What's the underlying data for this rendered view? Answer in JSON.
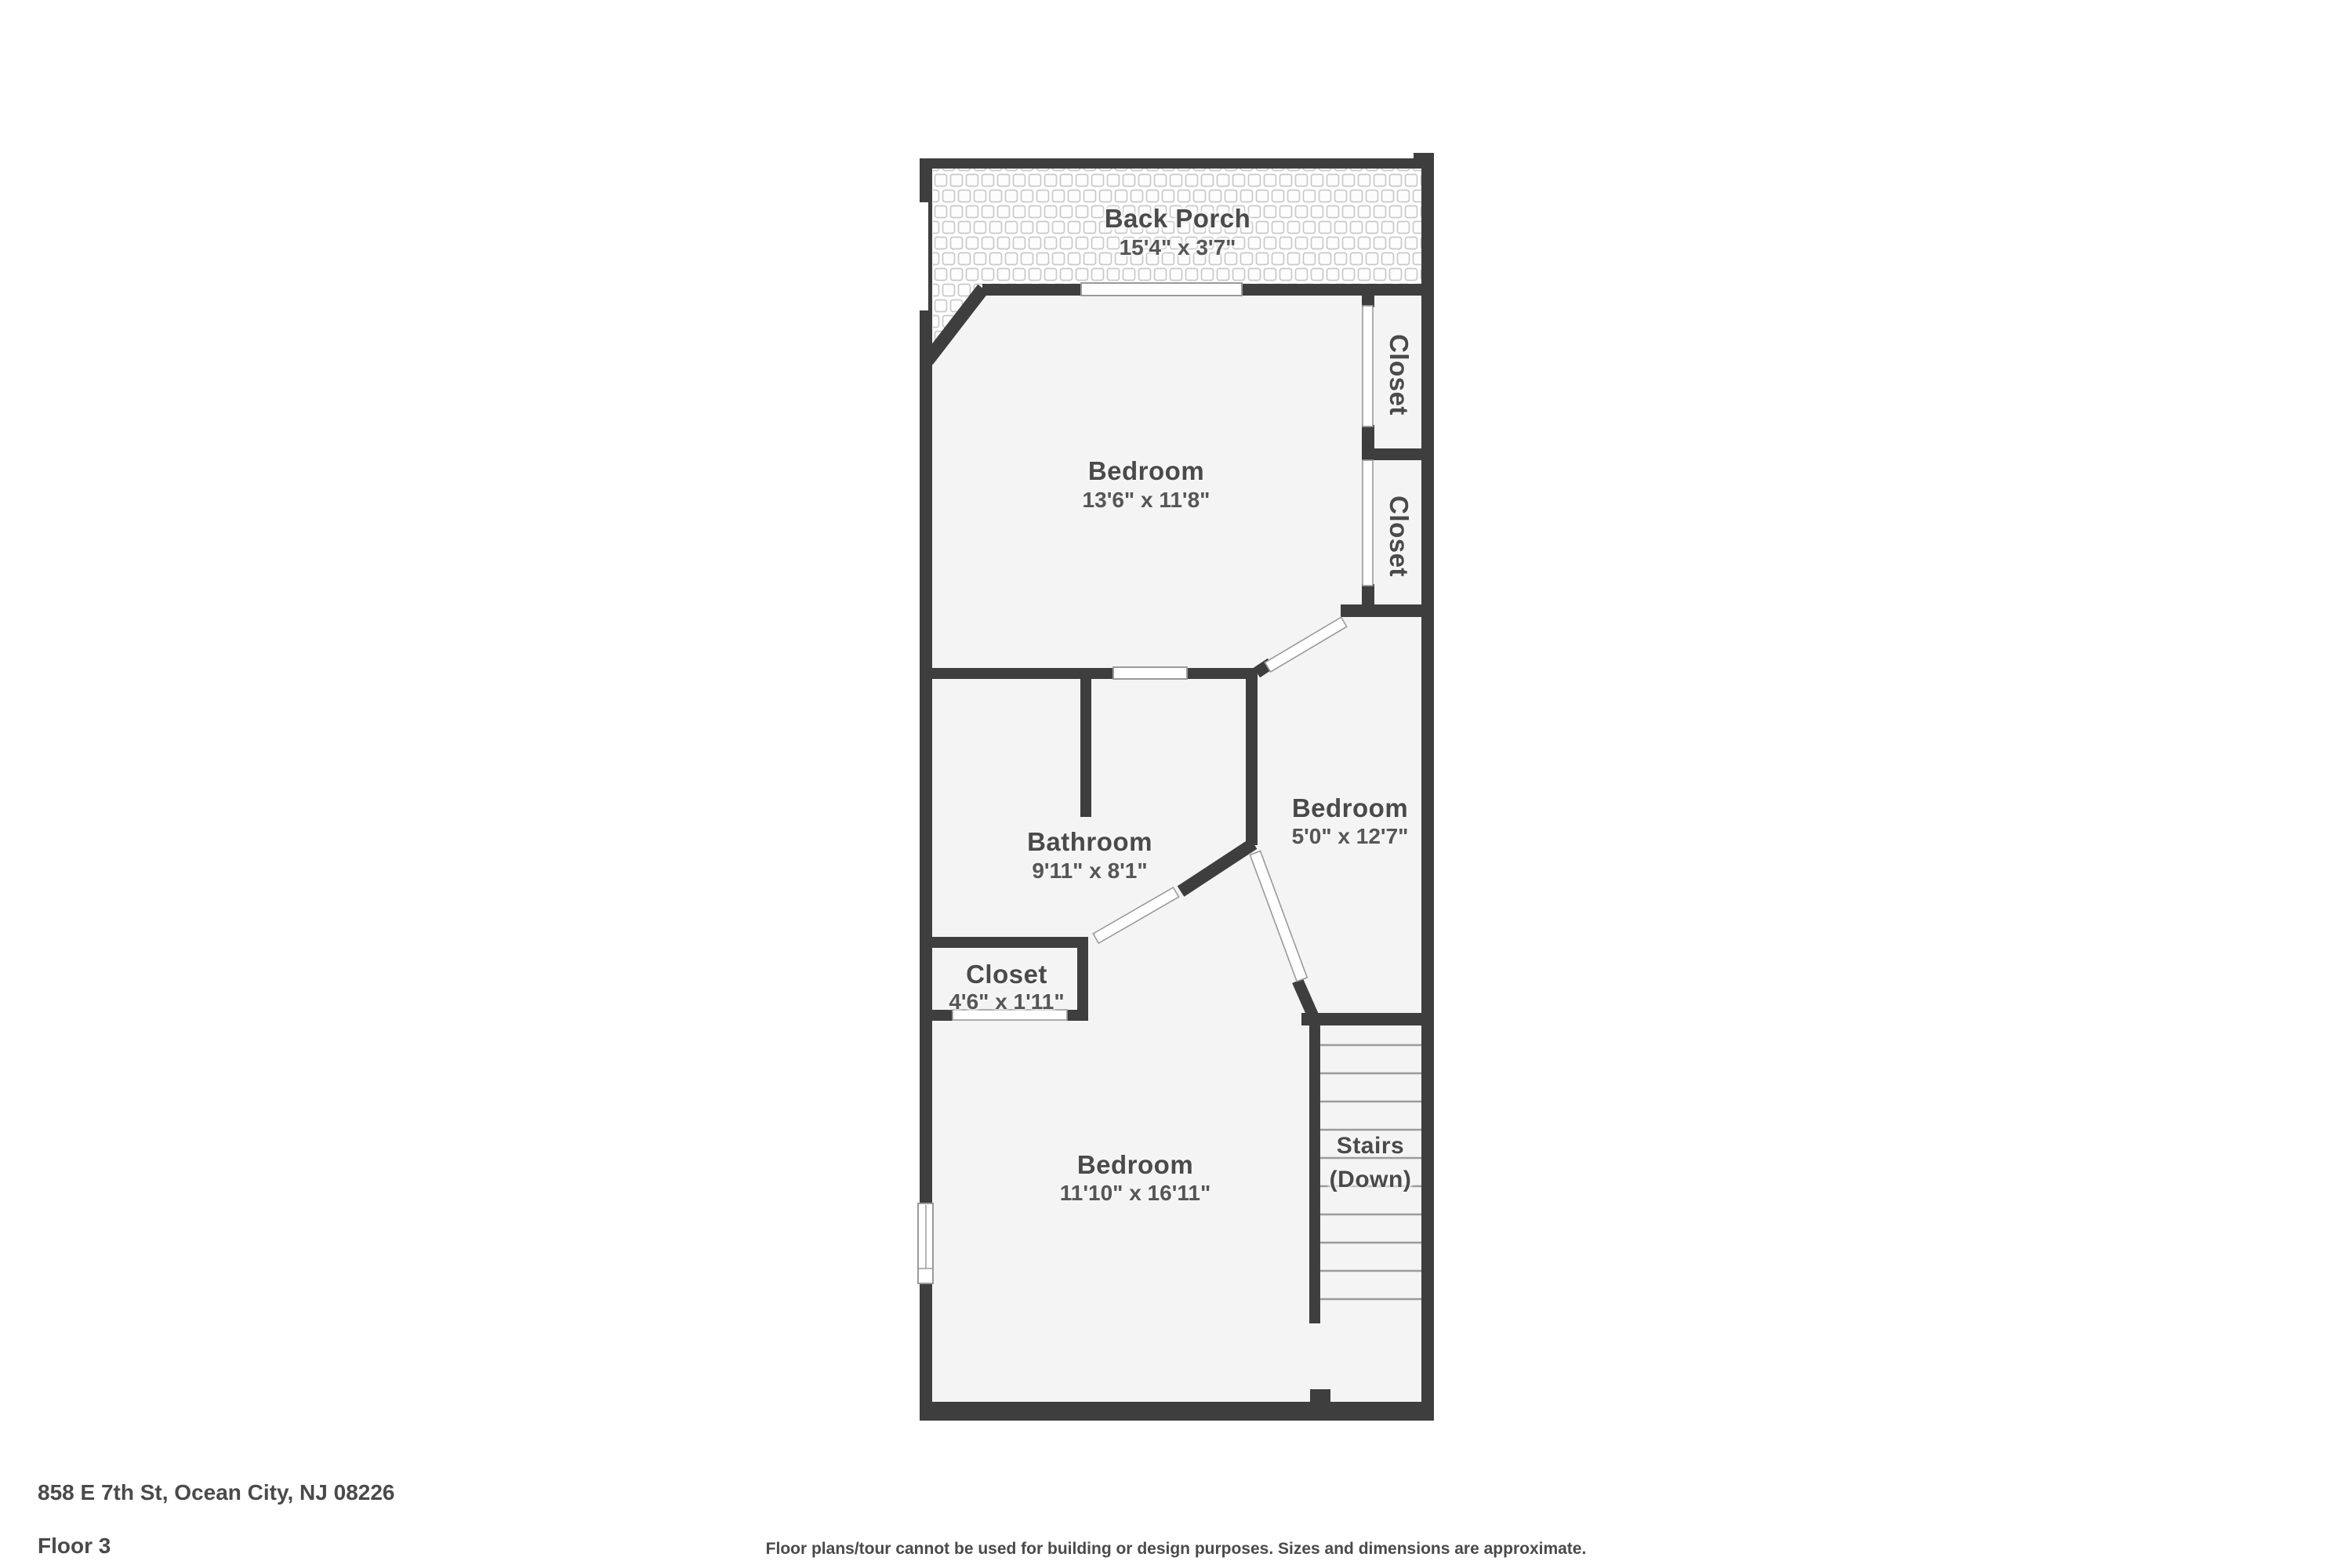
{
  "colors": {
    "wall": "#3e3e3e",
    "room_fill": "#f4f4f4",
    "tile_line": "#c9c9c9",
    "door_line": "#9a9a9a",
    "tread": "#9b9b9b",
    "label": "#4a4a4a",
    "dims": "#565656",
    "footer_text": "#4a4a4a"
  },
  "rooms": {
    "back_porch": {
      "label": "Back Porch",
      "dims": "15'4\" x 3'7\""
    },
    "bedroom_top": {
      "label": "Bedroom",
      "dims": "13'6\" x 11'8\""
    },
    "closet_upper": {
      "label": "Closet"
    },
    "closet_lower": {
      "label": "Closet"
    },
    "bathroom": {
      "label": "Bathroom",
      "dims": "9'11\" x 8'1\""
    },
    "bedroom_middle": {
      "label": "Bedroom",
      "dims": "5'0\" x 12'7\""
    },
    "closet_small": {
      "label": "Closet",
      "dims": "4'6\" x 1'11\""
    },
    "bedroom_bottom": {
      "label": "Bedroom",
      "dims": "11'10\" x 16'11\""
    },
    "stairs": {
      "label": "Stairs",
      "sublabel": "(Down)"
    }
  },
  "footer": {
    "address": "858 E 7th St, Ocean City, NJ 08226",
    "floor": "Floor 3",
    "disclaimer": "Floor plans/tour cannot be used for building or design purposes. Sizes and dimensions are approximate."
  }
}
